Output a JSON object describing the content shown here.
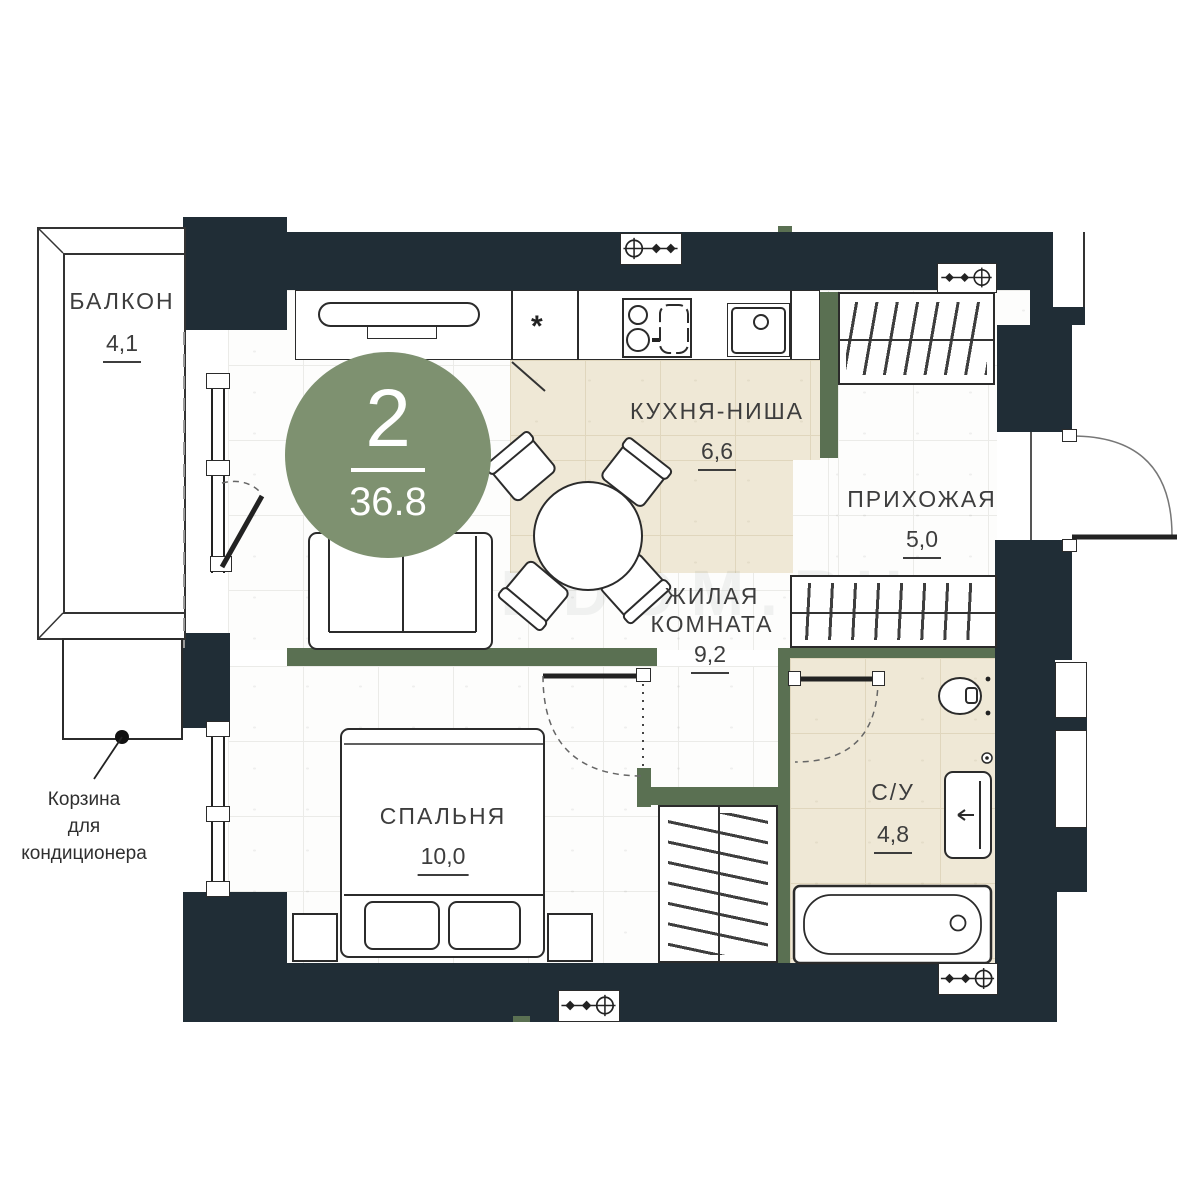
{
  "floorplan": {
    "badge": {
      "rooms_count": "2",
      "total_area": "36.8"
    },
    "rooms": [
      {
        "id": "balcony",
        "name": "БАЛКОН",
        "area": "4,1"
      },
      {
        "id": "kitchen",
        "name": "КУХНЯ-НИША",
        "area": "6,6"
      },
      {
        "id": "hallway",
        "name": "ПРИХОЖАЯ",
        "area": "5,0"
      },
      {
        "id": "living",
        "name_line1": "ЖИЛАЯ",
        "name_line2": "КОМНАТА",
        "area": "9,2"
      },
      {
        "id": "bedroom",
        "name": "СПАЛЬНЯ",
        "area": "10,0"
      },
      {
        "id": "bathroom",
        "name": "С/У",
        "area": "4,8"
      }
    ],
    "annotations": {
      "ac_basket_line1": "Корзина",
      "ac_basket_line2": "для",
      "ac_basket_line3": "кондиционера"
    },
    "watermark": "SIBDOM.RU",
    "symbols": {
      "fridge_star": "*"
    },
    "colors": {
      "wall_dark": "#202d36",
      "wall_green": "#5a7052",
      "badge_green": "#7e9170",
      "floor_beige": "#efe8d6"
    }
  }
}
